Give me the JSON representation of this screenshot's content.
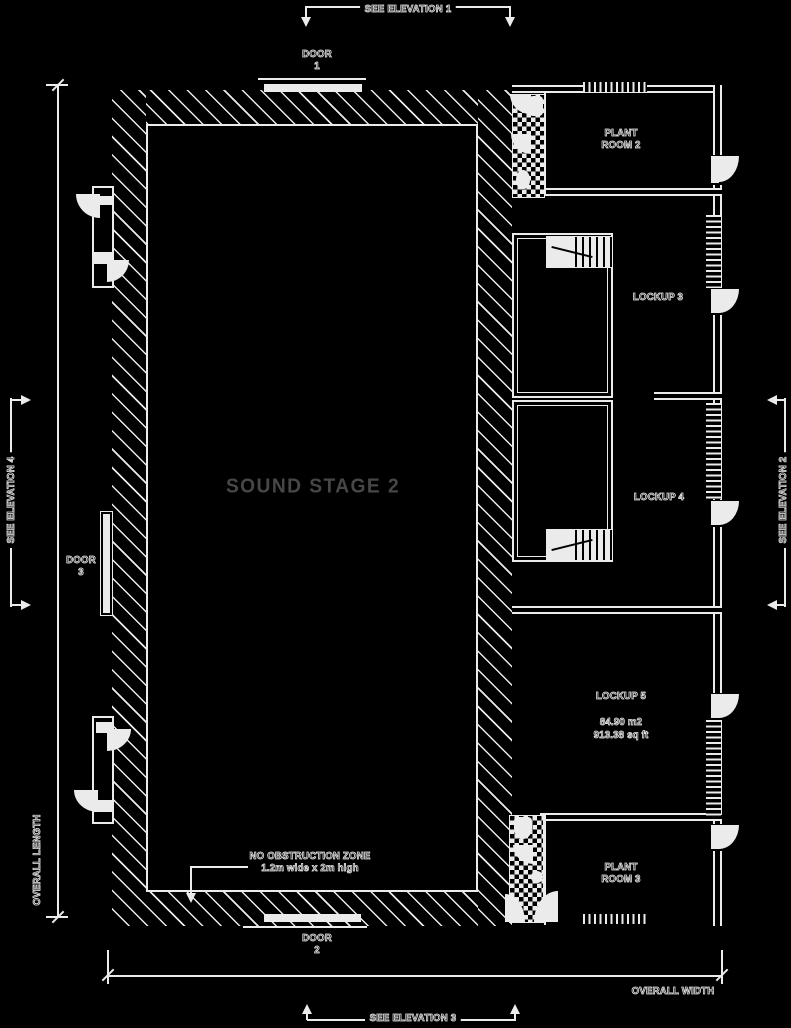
{
  "colors": {
    "background": "#000000",
    "ink": "#ebebeb",
    "stage_text": "#474747"
  },
  "elevation_markers": {
    "see_elevation_1": "SEE ELEVATION 1",
    "see_elevation_2": "SEE ELEVATION 2",
    "see_elevation_3": "SEE ELEVATION 3",
    "see_elevation_4": "SEE ELEVATION 4"
  },
  "dimensions": {
    "overall_length": "OVERALL LENGTH",
    "overall_width": "OVERALL WIDTH"
  },
  "doors": {
    "door_1": {
      "line1": "DOOR",
      "line2": "1"
    },
    "door_2": {
      "line1": "DOOR",
      "line2": "2"
    },
    "door_3": {
      "line1": "DOOR",
      "line2": "3"
    }
  },
  "rooms": {
    "sound_stage": {
      "label": "SOUND STAGE 2"
    },
    "plant_room_2": {
      "line1": "PLANT",
      "line2": "ROOM 2"
    },
    "plant_room_3": {
      "line1": "PLANT",
      "line2": "ROOM 3"
    },
    "lockup_3": {
      "label": "LOCKUP 3"
    },
    "lockup_4": {
      "label": "LOCKUP 4"
    },
    "lockup_5": {
      "label": "LOCKUP 5",
      "area_m2": "84.90 m2",
      "area_sqft": "913.38 sq ft"
    }
  },
  "notes": {
    "no_obstruction_line1": "NO OBSTRUCTION ZONE",
    "no_obstruction_line2": "1.2m wide x 2m high"
  }
}
